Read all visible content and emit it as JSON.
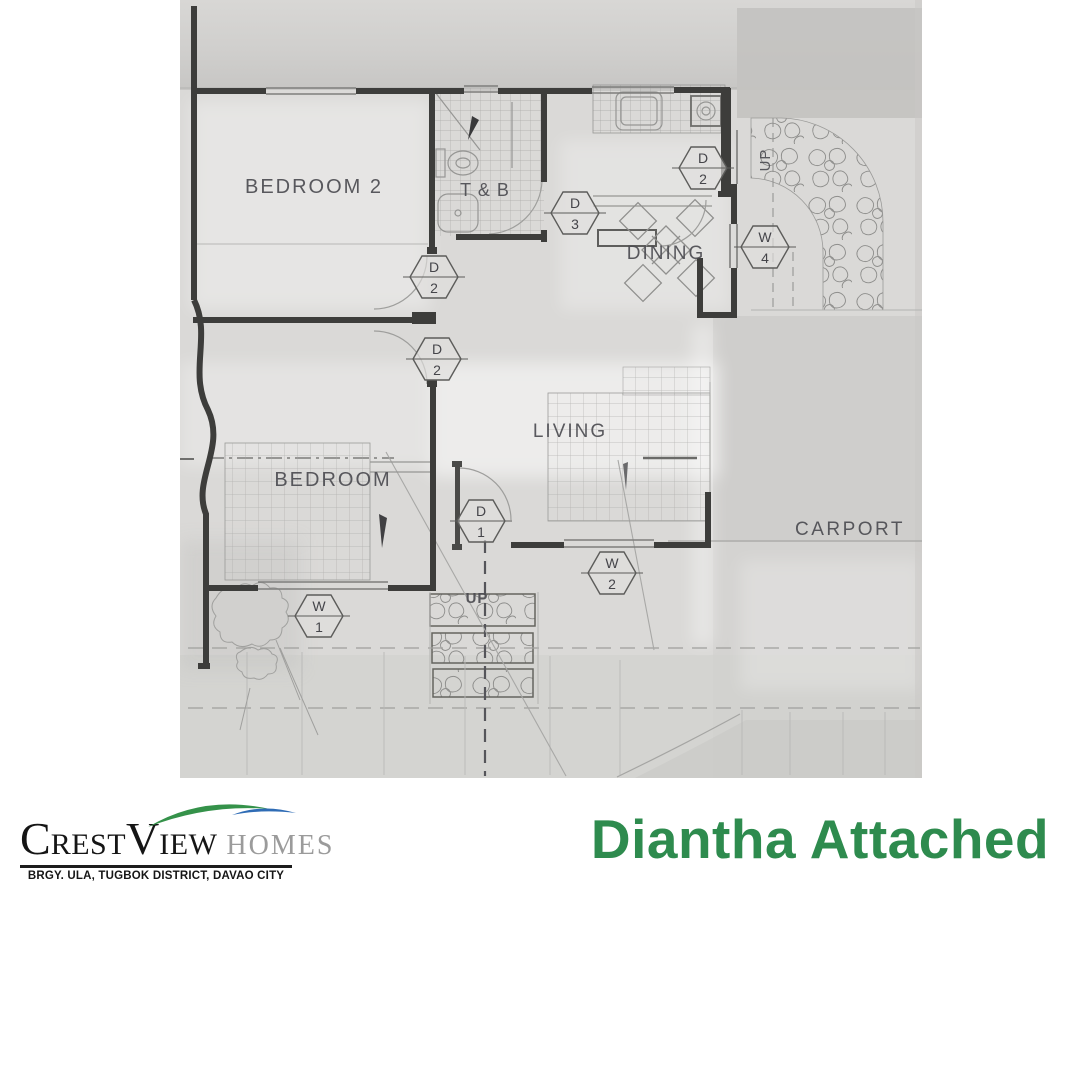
{
  "branding": {
    "title": "Diantha Attached",
    "logo": {
      "crest_c": "C",
      "crest_rest": "REST",
      "view_v": "V",
      "view_iew": "IEW",
      "homes": "HOMES",
      "address": "BRGY. ULA, TUGBOK DISTRICT, DAVAO CITY"
    }
  },
  "colors": {
    "title_green": "#2e8b4e",
    "swoosh_green": "#35924a",
    "swoosh_blue": "#2f6cb5",
    "wall_dark": "#3d3d3b",
    "pencil_gray": "#969694",
    "paper_gray": "#dad9d7"
  },
  "floor_plan": {
    "room_labels": [
      {
        "label": "BEDROOM 2",
        "x": 134,
        "y": 193,
        "size": 20,
        "ls": 2
      },
      {
        "label": "T & B",
        "x": 305,
        "y": 196,
        "size": 18,
        "ls": 1
      },
      {
        "label": "DINING",
        "x": 486,
        "y": 259,
        "size": 19,
        "ls": 2
      },
      {
        "label": "LIVING",
        "x": 390,
        "y": 437,
        "size": 19,
        "ls": 2
      },
      {
        "label": "BEDROOM",
        "x": 153,
        "y": 486,
        "size": 20,
        "ls": 2
      },
      {
        "label": "CARPORT",
        "x": 670,
        "y": 535,
        "size": 19,
        "ls": 2.5
      },
      {
        "label": "UP",
        "x": 297,
        "y": 603,
        "size": 15,
        "ls": 1,
        "bold": true
      },
      {
        "label": "UP",
        "x": 590,
        "y": 160,
        "size": 15,
        "ls": 1,
        "rotate": -90
      }
    ],
    "markers": [
      {
        "letter": "D",
        "number": "2",
        "x": 523,
        "y": 168
      },
      {
        "letter": "D",
        "number": "3",
        "x": 395,
        "y": 213
      },
      {
        "letter": "D",
        "number": "2",
        "x": 254,
        "y": 277
      },
      {
        "letter": "D",
        "number": "2",
        "x": 257,
        "y": 359
      },
      {
        "letter": "W",
        "number": "4",
        "x": 585,
        "y": 247
      },
      {
        "letter": "D",
        "number": "1",
        "x": 301,
        "y": 521
      },
      {
        "letter": "W",
        "number": "2",
        "x": 432,
        "y": 573
      },
      {
        "letter": "W",
        "number": "1",
        "x": 139,
        "y": 616
      }
    ]
  }
}
